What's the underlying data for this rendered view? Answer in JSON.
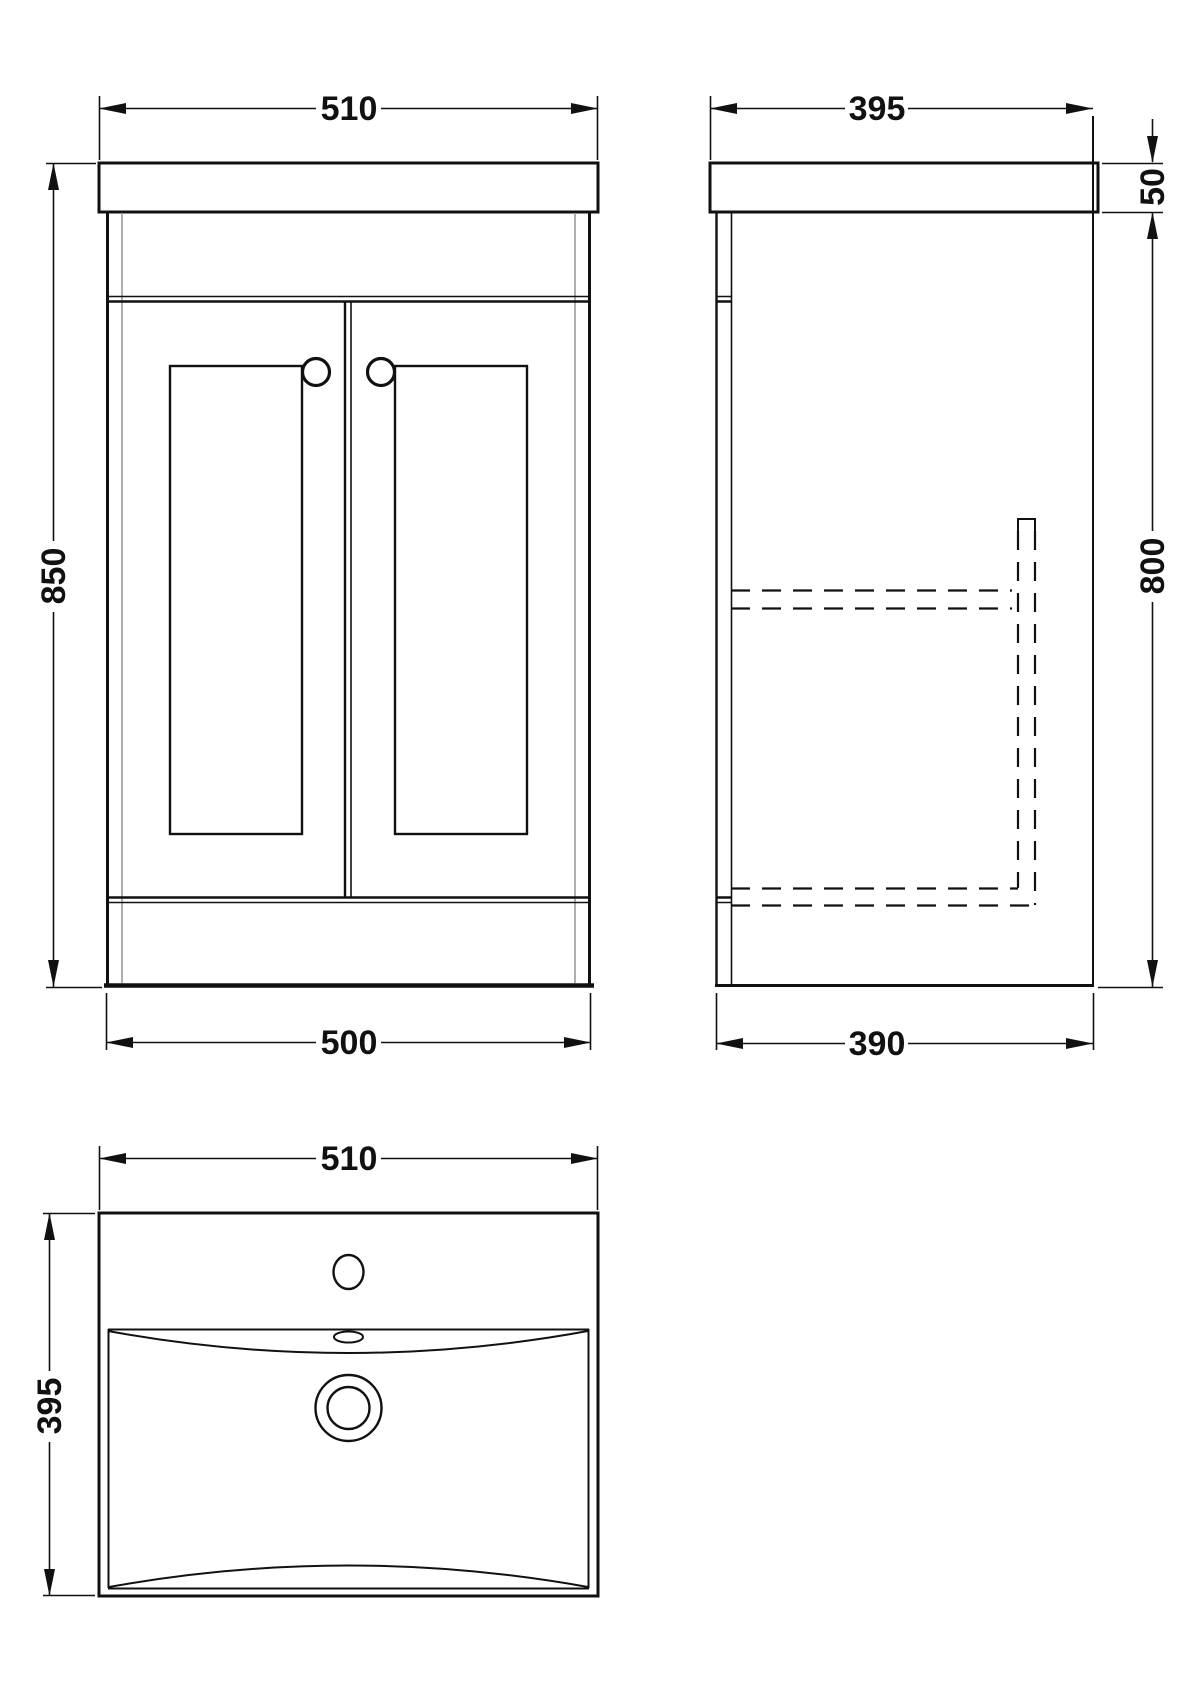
{
  "drawing": {
    "subject": "vanity-unit-with-basin-technical-drawing",
    "colors": {
      "line": "#111111",
      "light_line": "#9b9b9b",
      "background": "#ffffff"
    },
    "views": {
      "front": {
        "width_top": "510",
        "height": "850",
        "width_bottom": "500"
      },
      "side": {
        "depth_top": "395",
        "worktop_height": "50",
        "cabinet_height": "800",
        "depth_bottom": "390"
      },
      "basin": {
        "width": "510",
        "depth": "395"
      }
    }
  }
}
